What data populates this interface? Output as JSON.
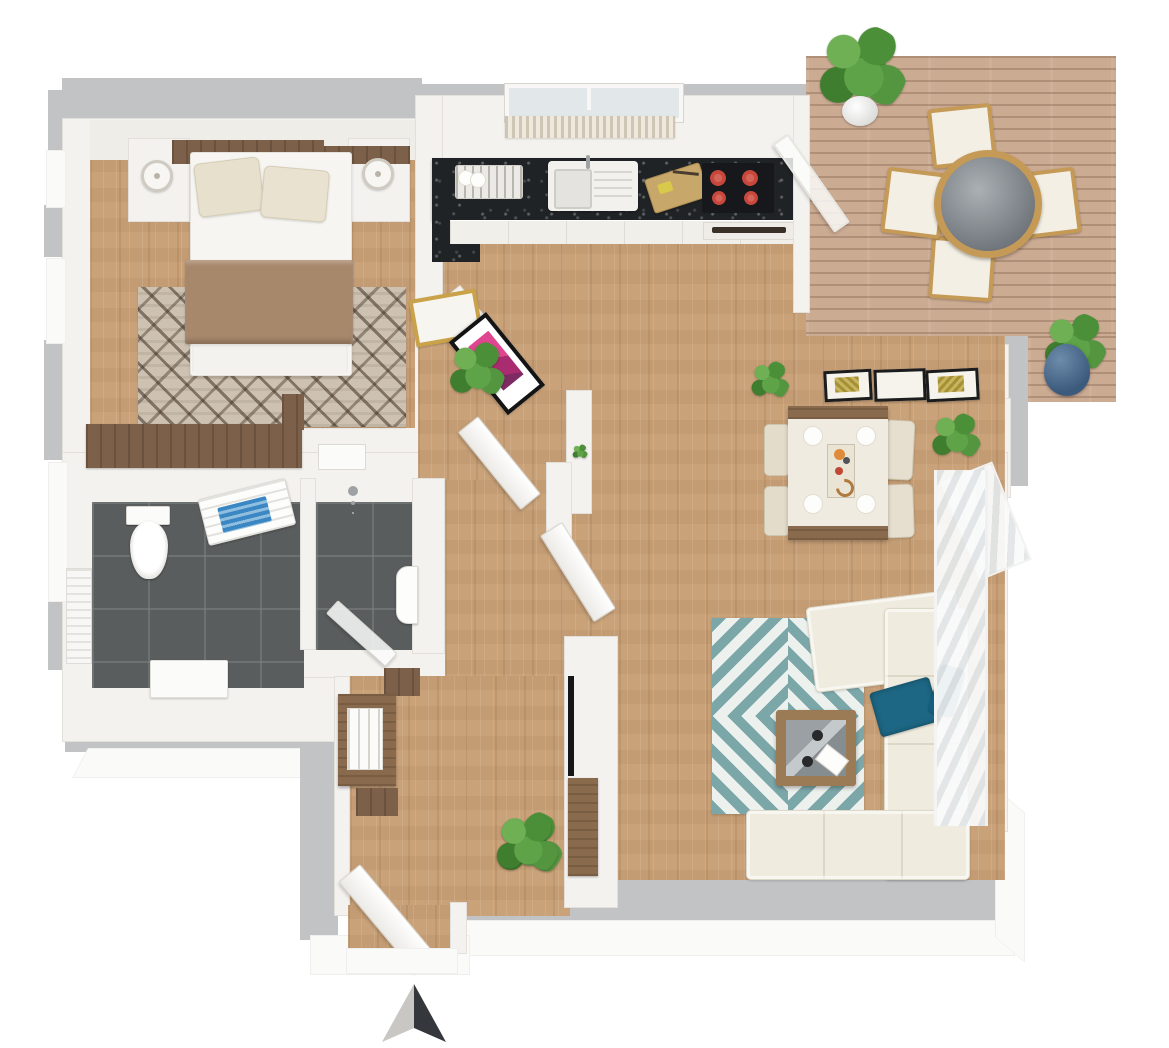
{
  "meta": {
    "title": "3D apartment floor plan — top-down render",
    "style": "photoreal 3D top view, no text labels",
    "compass": {
      "icon": "north-arrow-icon",
      "points": "up",
      "left_half_color": "#c9c7c3",
      "right_half_color": "#34373b"
    }
  },
  "palette": {
    "exterior_gray": "#c2c3c5",
    "wall_white": "#f4f2ef",
    "floor_wood": "#c8a179",
    "deck_wood": "#ccab93",
    "bathroom_tile": "#595d5e",
    "counter_black": "#202326",
    "rug_teal": "#7ca7a9",
    "rug_bedroom": "#cdc2b2",
    "sofa_cream": "#f0ebdf",
    "accent_blue": "#1d6784",
    "blanket_brown": "#a8886b",
    "burner_red": "#c8473c",
    "art_pink": "#d43180",
    "frame_gold": "#c9a24a",
    "furniture_wood": "#8a6a4c",
    "plant_green": "#4c8f39"
  },
  "rooms": {
    "bedroom": {
      "label": "Bedroom",
      "furniture": [
        "double bed with white duvet",
        "two beige pillows",
        "brown throw blanket",
        "dark wood headboard",
        "left nightstand with lamp",
        "right nightstand with lamp",
        "geometric area rug",
        "wardrobe band",
        "radiator"
      ]
    },
    "bathroom": {
      "label": "Bathroom",
      "furniture": [
        "toilet",
        "towel radiator with blue towel",
        "white bath mat",
        "walk-in shower",
        "shower glass door",
        "hand basin",
        "radiator"
      ]
    },
    "kitchen": {
      "label": "Kitchen",
      "furniture": [
        "black stone counter",
        "dish rack with plates",
        "sink with drainboard",
        "cutting board with knife",
        "cooktop with four burners",
        "oven with handle",
        "white base cabinets",
        "window with striped curtain",
        "glass door to deck"
      ]
    },
    "dining": {
      "label": "Dining area",
      "furniture": [
        "dining table with four plates and centerpiece runner",
        "four upholstered chairs",
        "three wall frames",
        "corner potted plant",
        "corner window with sheer curtain"
      ]
    },
    "living": {
      "label": "Living room",
      "furniture": [
        "L-shaped cream sectional sofa",
        "blue throw blanket",
        "blue pillow",
        "teal chevron rug",
        "square wood coffee table with glass top",
        "wall-mounted TV",
        "wood TV lowboard",
        "floor plant",
        "curtained window wall"
      ]
    },
    "hall": {
      "label": "Entrance hall",
      "furniture": [
        "console table with white tray",
        "dark wood runner",
        "entry door (open)",
        "interior doors (open)",
        "potted plant",
        "gold framed mirror",
        "pink framed artwork",
        "shelf with small plant"
      ]
    },
    "deck": {
      "label": "Terrace deck",
      "furniture": [
        "round glass-top table",
        "four wood chairs with white cushions",
        "plant in white pot",
        "plant in blue pot"
      ]
    }
  }
}
